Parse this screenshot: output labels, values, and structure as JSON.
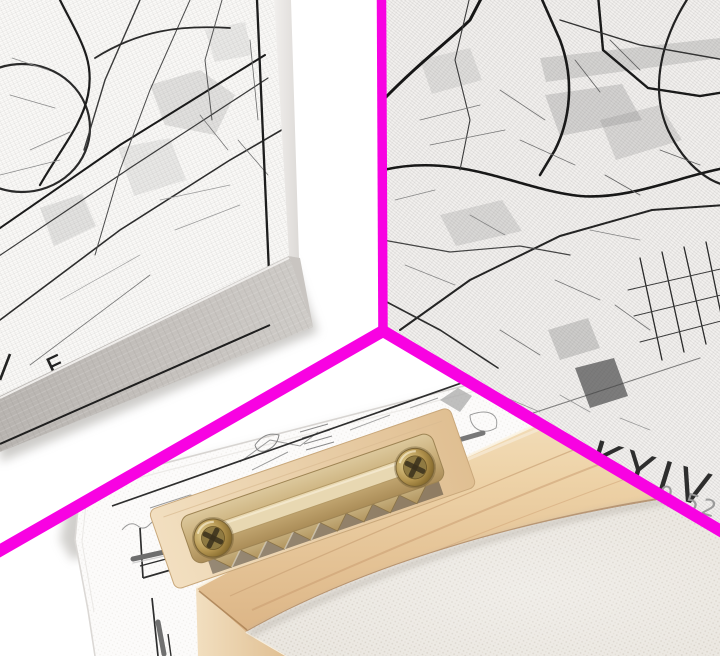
{
  "scene": {
    "type": "product-photo-collage",
    "description": "Three-panel collage mockup of a black and white Kyiv city map canvas print divided by magenta lines",
    "divider_color": "#F802E2",
    "background_color": "#ffffff"
  },
  "panels": {
    "top_left": {
      "name": "angled front mockup of map canvas",
      "visible_text": "E",
      "canvas_side_color": "#c2beba",
      "map_ink_color": "#222222"
    },
    "top_right": {
      "name": "close-up of map canvas corner",
      "city_label": "KYIV",
      "coordinates_fragment": "0.52",
      "city_label_color": "#1e1e1e",
      "coordinates_color": "#9b9b9b"
    },
    "bottom": {
      "name": "back of stretched canvas with sawtooth hanger",
      "wood_color": "#ecd3ae",
      "hanger_brass_color": "#c8ae7d",
      "screw_color": "#b3944f",
      "back_fabric_color": "#e9e5de"
    }
  }
}
